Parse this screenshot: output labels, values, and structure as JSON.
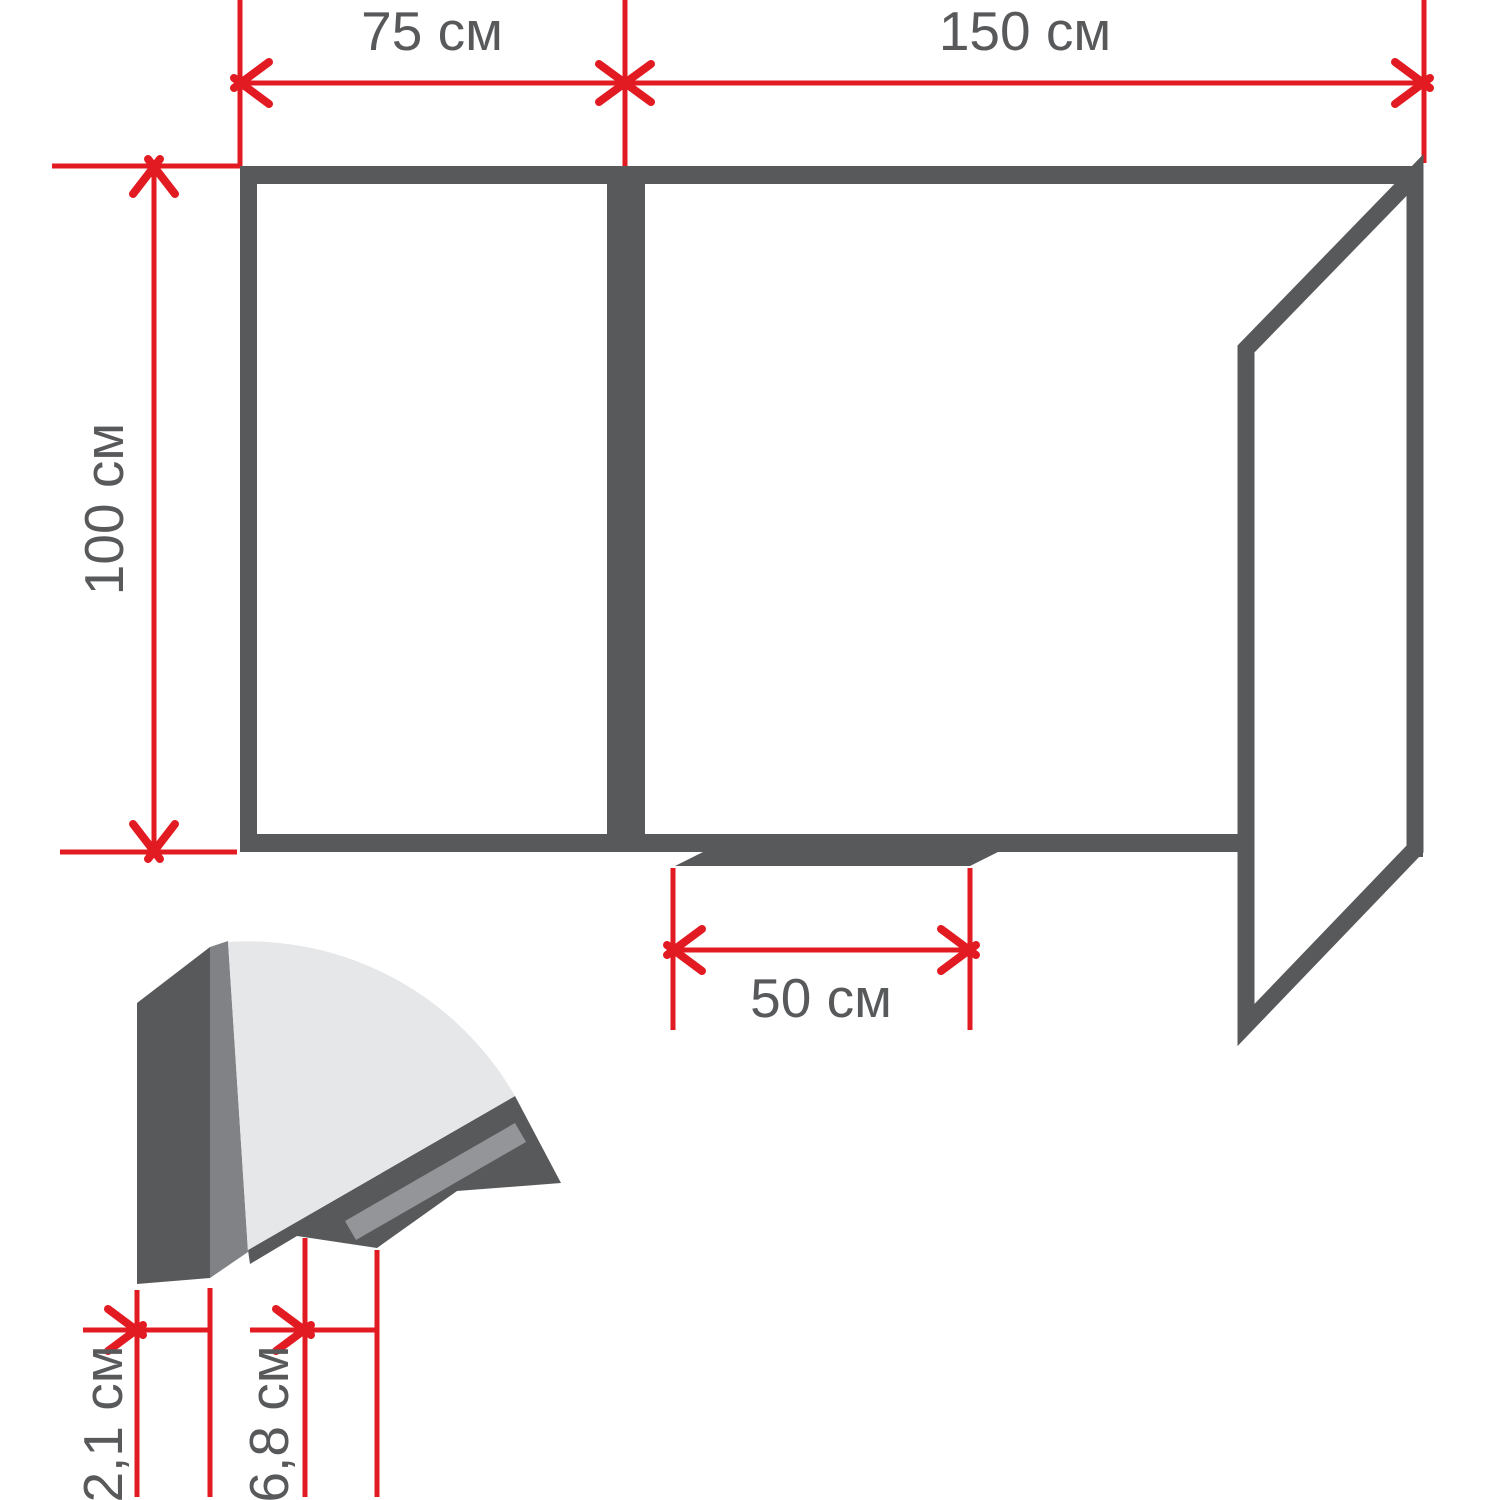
{
  "colors": {
    "accent_red": "#e21b22",
    "frame_dark": "#58595b",
    "panel_light": "#e6e7e8",
    "metal_medium": "#808285",
    "groove_gray": "#939598",
    "text_gray": "#58595b",
    "background": "#ffffff"
  },
  "dimensions": {
    "left_panel_width": "75 см",
    "main_panel_width": "150 см",
    "board_height": "100 см",
    "tray_length": "50 см",
    "profile_thickness": "2,1 см",
    "tray_depth": "6,8 см"
  }
}
